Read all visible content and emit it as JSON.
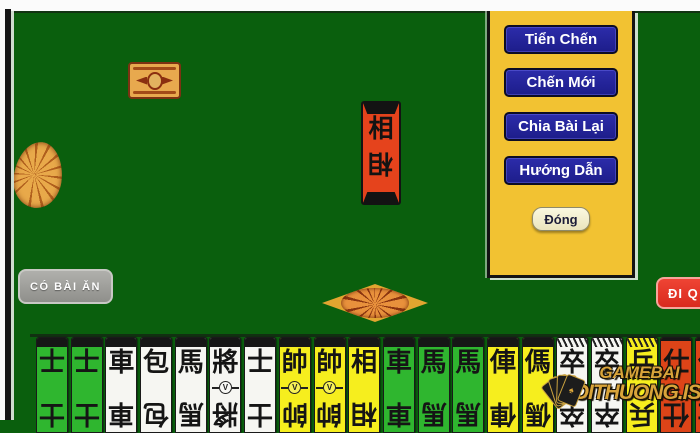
{
  "window": {
    "bg_color": "#0a5f0d",
    "frame_color": "#fbfbfb"
  },
  "menu_panel": {
    "bg_color": "#f2c232",
    "buttons": [
      {
        "label": "Tiển Chến"
      },
      {
        "label": "Chến Mới"
      },
      {
        "label": "Chia Bài Lại"
      },
      {
        "label": "Hướng Dẫn"
      }
    ],
    "close_button": "Đóng",
    "button_color": "#22229b"
  },
  "action_buttons": {
    "take_card": "CÓ BÀI ĂN",
    "pass": "ĐI Q",
    "take_card_color": "#9b9b97",
    "pass_color": "#e23327"
  },
  "board": {
    "center_card": {
      "char": "相",
      "color": "#e5431c"
    },
    "facedown_card": {
      "color": "#e8a94e"
    },
    "ornament_color": "#e2a530"
  },
  "hand": {
    "cards": [
      {
        "char": "士",
        "color": "green",
        "cap": "solid",
        "medal": false
      },
      {
        "char": "士",
        "color": "green",
        "cap": "solid",
        "medal": false
      },
      {
        "char": "車",
        "color": "white",
        "cap": "solid",
        "medal": false
      },
      {
        "char": "包",
        "color": "white",
        "cap": "solid",
        "medal": false
      },
      {
        "char": "馬",
        "color": "white",
        "cap": "solid",
        "medal": false
      },
      {
        "char": "將",
        "color": "white",
        "cap": "solid",
        "medal": true
      },
      {
        "char": "士",
        "color": "white",
        "cap": "solid",
        "medal": false
      },
      {
        "char": "帥",
        "color": "yellow",
        "cap": "solid",
        "medal": true
      },
      {
        "char": "帥",
        "color": "yellow",
        "cap": "solid",
        "medal": true
      },
      {
        "char": "相",
        "color": "yellow",
        "cap": "solid",
        "medal": false
      },
      {
        "char": "車",
        "color": "green",
        "cap": "solid",
        "medal": false
      },
      {
        "char": "馬",
        "color": "green",
        "cap": "solid",
        "medal": false
      },
      {
        "char": "馬",
        "color": "green",
        "cap": "solid",
        "medal": false
      },
      {
        "char": "俥",
        "color": "yellow",
        "cap": "solid",
        "medal": false
      },
      {
        "char": "傌",
        "color": "yellow",
        "cap": "solid",
        "medal": false
      },
      {
        "char": "卒",
        "color": "white",
        "cap": "hatch",
        "medal": false
      },
      {
        "char": "卒",
        "color": "white",
        "cap": "hatch",
        "medal": false
      },
      {
        "char": "兵",
        "color": "yellow",
        "cap": "hatch",
        "medal": false
      },
      {
        "char": "仕",
        "color": "red",
        "cap": "line",
        "medal": false
      },
      {
        "char": "仕",
        "color": "red",
        "cap": "line",
        "medal": false
      }
    ],
    "card_colors": {
      "green": "#2fb62f",
      "white": "#f6f6f2",
      "yellow": "#f6ee1e",
      "red": "#dd4418"
    }
  },
  "watermark": {
    "line1": "GAMEBAI",
    "line2": "DOITHUONG.IS",
    "color": "#d9a43a",
    "spade": "♠"
  }
}
